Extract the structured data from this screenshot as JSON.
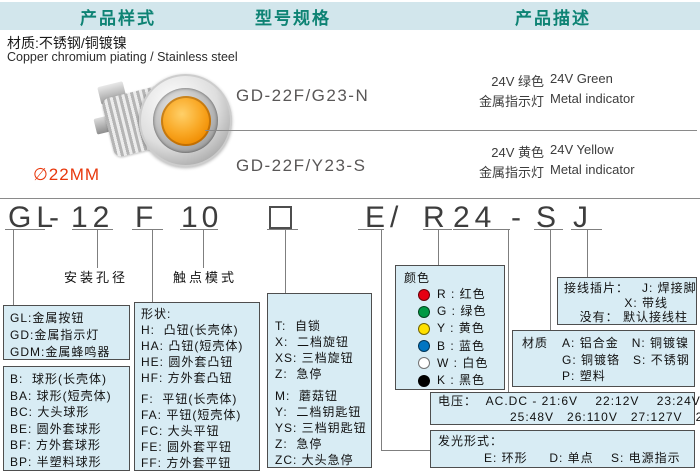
{
  "header": {
    "tabs": [
      {
        "label": "产品样式"
      },
      {
        "label": "型号规格"
      },
      {
        "label": "产品描述"
      }
    ]
  },
  "material_note": {
    "cn": "材质:不锈钢/铜镀镍",
    "en": "Copper chromium piating / Stainless  steel"
  },
  "product": {
    "diameter": "∅22MM",
    "lens_color": "#f9a825",
    "photo": "metal-indicator-light-photo"
  },
  "models": [
    {
      "code": "GD-22F/G23-N",
      "desc_cn": "24V 绿色",
      "desc_en": "24V Green",
      "type_cn": "金属指示灯",
      "type_en": "Metal indicator"
    },
    {
      "code": "GD-22F/Y23-S",
      "desc_cn": "24V 黄色",
      "desc_en": "24V Yellow",
      "type_cn": "金属指示灯",
      "type_en": "Metal indicator"
    }
  ],
  "order_code": {
    "segments": {
      "gl": "GL",
      "dash1": "-",
      "d12": "12",
      "f": "F",
      "d10": "10",
      "square": "□",
      "e": "E",
      "slash": "/",
      "r": "R",
      "d24": "24",
      "dash2": "-",
      "s": "S",
      "j": "J"
    },
    "labels": {
      "mounting": "安装孔径",
      "contact": "触点模式"
    }
  },
  "boxes": {
    "series": {
      "items": [
        "GL:金属按钮",
        "GD:金属指示灯",
        "GDM:金属蜂鸣器"
      ]
    },
    "ball": {
      "items": [
        "B:  球形(长壳体)",
        "BA: 球形(短壳体)",
        "BC: 大头球形",
        "BE: 圆外套球形",
        "BF: 方外套球形",
        "BP: 半塑料球形"
      ]
    },
    "shape": {
      "title": "形状:",
      "group1": [
        "H:  凸钮(长壳体)",
        "HA: 凸钮(短壳体)",
        "HE: 圆外套凸钮",
        "HF: 方外套凸钮"
      ],
      "group2": [
        "F:  平钮(长壳体)",
        "FA: 平钮(短壳体)",
        "FC: 大头平钮",
        "FE: 圆外套平钮",
        "FF: 方外套平钮"
      ]
    },
    "action": {
      "group1": [
        "T:  自锁",
        "X:  二档旋钮",
        "XS: 三档旋钮",
        "Z:  急停"
      ],
      "group2": [
        "M:  蘑菇钮",
        "Y:  二档钥匙钮",
        "YS: 三档钥匙钮",
        "Z:  急停",
        "ZC: 大头急停"
      ]
    },
    "color": {
      "title": "颜色",
      "items": [
        {
          "label": "R : 红色",
          "hex": "#e60012"
        },
        {
          "label": "G : 绿色",
          "hex": "#009944"
        },
        {
          "label": "Y : 黄色",
          "hex": "#ffe100"
        },
        {
          "label": "B : 蓝色",
          "hex": "#0075c2"
        },
        {
          "label": "W : 白色",
          "hex": "#ffffff"
        },
        {
          "label": "K : 黑色",
          "hex": "#000000"
        }
      ]
    },
    "terminal": {
      "line1": "接线插片：   J: 焊接脚",
      "line2": "X: 带线",
      "line3": "没有： 默认接线柱"
    },
    "material": {
      "label": "材质",
      "rows": [
        "A: 铝合金   N: 铜镀镍",
        "G: 铜镀铬   S: 不锈钢",
        "P: 塑料"
      ]
    },
    "voltage": {
      "line1": "电压：  AC.DC - 21:6V    22:12V    23:24V    24:36V",
      "line2": "25:48V   26:110V   27:127V   28:220V"
    },
    "light": {
      "title": "发光形式：",
      "line": "E: 环形     D: 单点    S: 电源指示"
    }
  },
  "theme": {
    "header_bg": "#d2e6ec",
    "header_text": "#0e8374",
    "box_bg": "#d8ecf4",
    "box_border": "#4e4e4e",
    "accent_red": "#e8380d"
  }
}
